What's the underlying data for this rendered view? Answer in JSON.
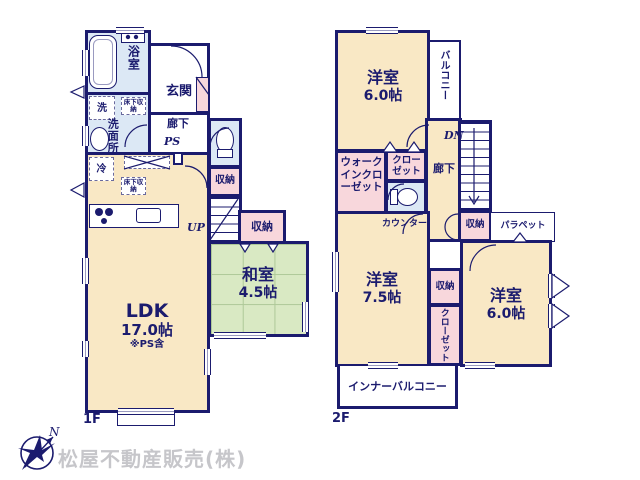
{
  "colors": {
    "wall": "#1b1b6e",
    "room_cream": "#f9e8c5",
    "closet_pink": "#f8d7dc",
    "wet_area_blue": "#dce8f5",
    "tatami_green": "#d9e9c3",
    "company_gray": "#c6c6ca"
  },
  "icons": {
    "compass": "compass-north-arrow",
    "bathtub": "bathtub-outline",
    "toilet": "toilet-outline",
    "sink": "round-basin",
    "stove": "three-burner-stove"
  },
  "floor1": {
    "floor_label": "1F",
    "bath": "浴室",
    "entrance": "玄関",
    "laundry": "洗",
    "washroom": "洗面所",
    "underfloor_storage_1": "床下収納",
    "underfloor_storage_2": "床下収納",
    "hallway": "廊下",
    "pipe_space": "PS",
    "fridge": "冷",
    "stairs_up": "UP",
    "storage_top": "収納",
    "storage_side": "収納",
    "ldk": {
      "name": "LDK",
      "size": "17.0帖",
      "note": "※PS含"
    },
    "washitsu": {
      "name": "和室",
      "size": "4.5帖"
    }
  },
  "floor2": {
    "floor_label": "2F",
    "bedroom_top": {
      "name": "洋室",
      "size": "6.0帖"
    },
    "balcony": "バルコニー",
    "stairs_down": "DN",
    "walk_in_closet": "ウォークインクローゼット",
    "closet_top": "クローゼット",
    "hallway": "廊下",
    "counter": "カウンター",
    "storage_hall": "収納",
    "parapet": "パラペット",
    "bedroom_left": {
      "name": "洋室",
      "size": "7.5帖"
    },
    "storage_mid": "収納",
    "closet_mid": "クローゼット",
    "bedroom_right": {
      "name": "洋室",
      "size": "6.0帖"
    },
    "inner_balcony": "インナーバルコニー"
  },
  "footer": {
    "compass_north": "N",
    "company": "松屋不動産販売(株)"
  }
}
